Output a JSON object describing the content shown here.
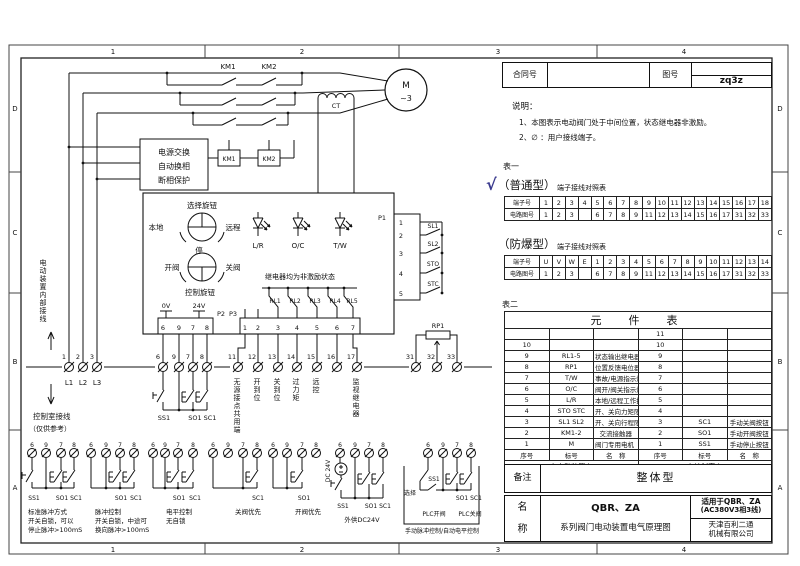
{
  "zones": {
    "cols": [
      "1",
      "2",
      "3",
      "4"
    ],
    "rows": [
      "D",
      "C",
      "B",
      "A"
    ]
  },
  "header": {
    "contract_label": "合同号",
    "contract_value": "",
    "drawing_label": "图号",
    "drawing_value": "zq3z"
  },
  "notes": {
    "title": "说明：",
    "line1": "1、本图表示电动阀门处于中间位置，状态继电器非激励。",
    "line2": "2、∅ ：用户接线端子。"
  },
  "table1": {
    "label": "表一",
    "check": "√",
    "normal_title": "（普通型）",
    "explosion_title": "（防爆型）",
    "subtitle": "端子接线对照表",
    "terminal_row_label": "端子号",
    "circuit_row_label": "电路图号",
    "normal_terminals": [
      "1",
      "2",
      "3",
      "4",
      "5",
      "6",
      "7",
      "8",
      "9",
      "10",
      "11",
      "12",
      "13",
      "14",
      "15",
      "16",
      "17",
      "18"
    ],
    "explosion_terminals": [
      "U",
      "V",
      "W",
      "E",
      "1",
      "2",
      "3",
      "4",
      "5",
      "6",
      "7",
      "8",
      "9",
      "10",
      "11",
      "12",
      "13",
      "14"
    ],
    "circuit_numbers": [
      "1",
      "2",
      "3",
      "",
      "6",
      "7",
      "8",
      "9",
      "11",
      "12",
      "13",
      "14",
      "15",
      "16",
      "17",
      "31",
      "32",
      "33"
    ]
  },
  "table2": {
    "label": "表二",
    "title": "元　件　表",
    "col_no": "序号",
    "col_code": "标号",
    "col_name": "名　称",
    "rows": [
      {
        "n1": "",
        "c1": "",
        "m1": "",
        "n2": "11",
        "c2": "",
        "m2": ""
      },
      {
        "n1": "10",
        "c1": "",
        "m1": "",
        "n2": "10",
        "c2": "",
        "m2": ""
      },
      {
        "n1": "9",
        "c1": "RL1-5",
        "m1": "状态输出继电器",
        "n2": "9",
        "c2": "",
        "m2": ""
      },
      {
        "n1": "8",
        "c1": "RP1",
        "m1": "位置反馈电位器",
        "n2": "8",
        "c2": "",
        "m2": ""
      },
      {
        "n1": "7",
        "c1": "T/W",
        "m1": "事故/电源指示灯",
        "n2": "7",
        "c2": "",
        "m2": ""
      },
      {
        "n1": "6",
        "c1": "O/C",
        "m1": "阀开/阀关指示灯",
        "n2": "6",
        "c2": "",
        "m2": ""
      },
      {
        "n1": "5",
        "c1": "L/R",
        "m1": "本地/远程工作指示灯",
        "n2": "5",
        "c2": "",
        "m2": ""
      },
      {
        "n1": "4",
        "c1": "STO STC",
        "m1": "开、关向力矩限位开关",
        "n2": "4",
        "c2": "",
        "m2": ""
      },
      {
        "n1": "3",
        "c1": "SL1 SL2",
        "m1": "开、关向行程限位开关",
        "n2": "3",
        "c2": "SC1",
        "m2": "手动关阀按钮"
      },
      {
        "n1": "2",
        "c1": "KM1-2",
        "m1": "交流接触器",
        "n2": "2",
        "c2": "SO1",
        "m2": "手动开阀按钮"
      },
      {
        "n1": "1",
        "c1": "M",
        "m1": "阀门专用电机（AC380V）",
        "n2": "1",
        "c2": "SS1",
        "m2": "手动停止按钮"
      }
    ],
    "footer_left": "在电动装置上",
    "footer_right": "在控制室内"
  },
  "remark": {
    "label": "备注",
    "value": "整体型"
  },
  "titleblock": {
    "name1": "名",
    "name2": "称",
    "model": "QBR、ZA",
    "desc": "系列阀门电动装置电气原理图",
    "apply1": "适用于QBR、ZA",
    "apply2": "(AC380V3相3线)",
    "company1": "天津百利二通",
    "company2": "机械有限公司"
  },
  "sch": {
    "km1": "KM1",
    "km2": "KM2",
    "m": "M",
    "ph": "~3",
    "ct": "CT",
    "psu1": "电源交换",
    "psu2": "自动换相",
    "psu3": "断相保护",
    "coil1": "KM1",
    "coil2": "KM2",
    "sel_knob": "选择旋钮",
    "local": "本地",
    "remote": "远程",
    "stop": "停",
    "open": "开阀",
    "close": "关阀",
    "ctrl_knob": "控制旋钮",
    "led1": "L/R",
    "led2": "O/C",
    "led3": "T/W",
    "relay_note": "继电器均为非激励状态",
    "rl1": "RL1",
    "rl2": "RL2",
    "rl3": "RL3",
    "rl4": "RL4",
    "rl5": "RL5",
    "p1": "P1",
    "p2": "P2",
    "p3": "P3",
    "p1p": [
      "1",
      "2",
      "3",
      "4",
      "5"
    ],
    "p2p": [
      "6",
      "9",
      "7",
      "8"
    ],
    "p3p": [
      "1",
      "2",
      "3",
      "4",
      "5",
      "6",
      "7"
    ],
    "sl1": "SL1",
    "sl2": "SL2",
    "sto": "STO",
    "stc": "STC",
    "v0": "0V",
    "v24": "24V",
    "rp1": "RP1",
    "t123": [
      "1",
      "2",
      "3"
    ],
    "l123": [
      "L1",
      "L2",
      "L3"
    ],
    "tmain": [
      "6",
      "9",
      "7",
      "8"
    ],
    "tsig": [
      "11",
      "12",
      "13",
      "14",
      "15",
      "16",
      "17"
    ],
    "tpot": [
      "31",
      "32",
      "33"
    ],
    "internal": "电动装置内部接线",
    "room": "控制室接线",
    "ref": "（仅供参考）",
    "sig1": "无源接点共用端",
    "sig2": "开到位",
    "sig3": "关到位",
    "sig4": "过力矩",
    "sig5": "远控",
    "sig6": "监视继电器",
    "ss1": "SS1",
    "so1": "SO1",
    "sc1": "SC1"
  },
  "options": {
    "g1": {
      "t": [
        "6",
        "9",
        "7",
        "8"
      ],
      "b1": "SS1",
      "b2": "SO1",
      "b3": "SC1",
      "c1": "标准脉冲方式",
      "c2": "开关自锁，可以",
      "c3": "停止脉冲>100mS"
    },
    "g2": {
      "t": [
        "6",
        "9",
        "7",
        "8"
      ],
      "b1": "SO1",
      "b2": "SC1",
      "c1": "脉冲控制",
      "c2": "开关自锁，中途可",
      "c3": "换向脉冲>100mS"
    },
    "g3": {
      "t": [
        "6",
        "9",
        "7",
        "8"
      ],
      "b1": "SO1",
      "b2": "SC1",
      "c1": "电平控制",
      "c2": "无自锁"
    },
    "g4": {
      "t": [
        "6",
        "9",
        "7",
        "8"
      ],
      "b1": "SC1",
      "c1": "关阀优先"
    },
    "g5": {
      "t": [
        "6",
        "9",
        "7",
        "8"
      ],
      "b1": "SO1",
      "c1": "开阀优先"
    },
    "g6": {
      "t": [
        "6",
        "9",
        "7",
        "8"
      ],
      "src": "DC 24V",
      "b1": "SS1",
      "b2": "SO1",
      "b3": "SC1",
      "c1": "外供DC24V"
    },
    "g7": {
      "t": [
        "6",
        "9",
        "7",
        "8"
      ],
      "sel": "选择",
      "b1": "SS1",
      "b2": "SO1",
      "b3": "SC1",
      "plc_open": "PLC开阀",
      "plc_close": "PLC关阀",
      "c1": "手动脉冲控制/自动电平控制"
    }
  }
}
